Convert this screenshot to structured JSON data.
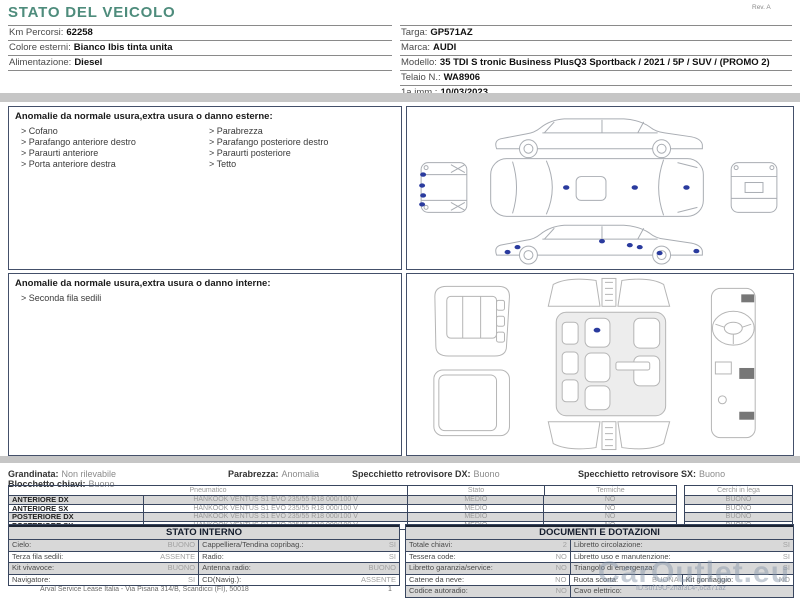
{
  "page": {
    "title": "STATO DEL VEICOLO",
    "revision": "Rev. A",
    "footer": "Arval Service Lease Italia - Via Pisana 314/B, Scandicci (FI), 50018",
    "page_number": "1",
    "watermark": "CarOutlet.eu",
    "doc_id": "ID:suf19O-2naf3L4-,6ca71az"
  },
  "vehicle": {
    "left_rows": [
      {
        "label": "Km Percorsi:",
        "value": "62258"
      },
      {
        "label": "Colore esterni:",
        "value": "Bianco Ibis tinta unita"
      },
      {
        "label": "Alimentazione:",
        "value": "Diesel"
      }
    ],
    "right_rows": [
      {
        "label": "Targa:",
        "value": "GP571AZ"
      },
      {
        "label": "Marca:",
        "value": "AUDI"
      },
      {
        "label": "Modello:",
        "value": "35 TDI S tronic Business PlusQ3 Sportback / 2021 / 5P / SUV / (PROMO 2)"
      },
      {
        "label": "Telaio N.:",
        "value": "WA8906"
      },
      {
        "label": "1a imm.:",
        "value": "10/03/2023"
      }
    ]
  },
  "exterior_anomalies": {
    "heading": "Anomalie da normale usura,extra usura o danno esterne:",
    "column1": [
      "> Cofano",
      "> Parafango anteriore destro",
      "> Paraurti anteriore",
      "> Porta anteriore destra"
    ],
    "column2": [
      "> Parabrezza",
      "> Parafango posteriore destro",
      "> Paraurti posteriore",
      "> Tetto"
    ]
  },
  "interior_anomalies": {
    "heading": "Anomalie da normale usura,extra usura o danno interne:",
    "items": [
      "> Seconda fila sedili"
    ]
  },
  "condition_summary": {
    "items": [
      {
        "label": "Grandinata:",
        "value": "Non rilevabile"
      },
      {
        "label": "Parabrezza:",
        "value": "Anomalia"
      },
      {
        "label": "Specchietto retrovisore DX:",
        "value": "Buono"
      },
      {
        "label": "Specchietto retrovisore SX:",
        "value": "Buono"
      },
      {
        "label": "Blocchetto chiavi:",
        "value": "Buono"
      }
    ]
  },
  "tire_table": {
    "headers": {
      "pneumatico": "Pneumatico",
      "stato": "Stato",
      "termiche": "Termiche",
      "cerchi": "Cerchi in lega"
    },
    "rows": [
      {
        "position": "ANTERIORE DX",
        "tire": "HANKOOK VENTUS S1 EVO 235/55 R18 000/100 V",
        "stato": "MEDIO",
        "termiche": "NO",
        "cerchi": "BUONO"
      },
      {
        "position": "ANTERIORE SX",
        "tire": "HANKOOK VENTUS S1 EVO 235/55 R18 000/100 V",
        "stato": "MEDIO",
        "termiche": "NO",
        "cerchi": "BUONO"
      },
      {
        "position": "POSTERIORE DX",
        "tire": "HANKOOK VENTUS S1 EVO 235/55 R18 000/100 V",
        "stato": "MEDIO",
        "termiche": "NO",
        "cerchi": "BUONO"
      },
      {
        "position": "POSTERIORE SX",
        "tire": "HANKOOK VENTUS S1 EVO 235/55 R18 000/100 V",
        "stato": "MEDIO",
        "termiche": "NO",
        "cerchi": "BUONO"
      }
    ]
  },
  "stato_interno": {
    "title": "STATO INTERNO",
    "rows": [
      {
        "label1": "Cielo:",
        "value1": "BUONO",
        "label2": "Cappelliera/Tendina copribag.:",
        "value2": "SI"
      },
      {
        "label1": "Terza fila sedili:",
        "value1": "ASSENTE",
        "label2": "Radio:",
        "value2": "SI"
      },
      {
        "label1": "Kit vivavoce:",
        "value1": "BUONO",
        "label2": "Antenna radio:",
        "value2": "BUONO"
      },
      {
        "label1": "Navigatore:",
        "value1": "SI",
        "label2": "CD(Navig.):",
        "value2": "ASSENTE"
      }
    ]
  },
  "documenti": {
    "title": "DOCUMENTI E DOTAZIONI",
    "rows": [
      {
        "label1": "Totale chiavi:",
        "value1": "2",
        "label2": "Libretto circolazione:",
        "value2": "SI"
      },
      {
        "label1": "Tessera code:",
        "value1": "NO",
        "label2": "Libretto uso e manutenzione:",
        "value2": "SI"
      },
      {
        "label1": "Libretto garanzia/service:",
        "value1": "NO",
        "label2": "Triangolo di emergenza:",
        "value2": "SI"
      },
      {
        "label1": "Catene da neve:",
        "value1": "NO",
        "label2": "Ruota scorta:",
        "value2": "BUONA",
        "label3": "Kit gonfiaggio:",
        "value3": "NO"
      },
      {
        "label1": "Codice autoradio:",
        "value1": "NO",
        "label2": "Cavo elettrico:",
        "value2": ""
      }
    ]
  },
  "colors": {
    "title_teal": "#4e8c7c",
    "damage_dot_blue": "#2a3b9e",
    "row_shade": "#d8d8d8"
  }
}
